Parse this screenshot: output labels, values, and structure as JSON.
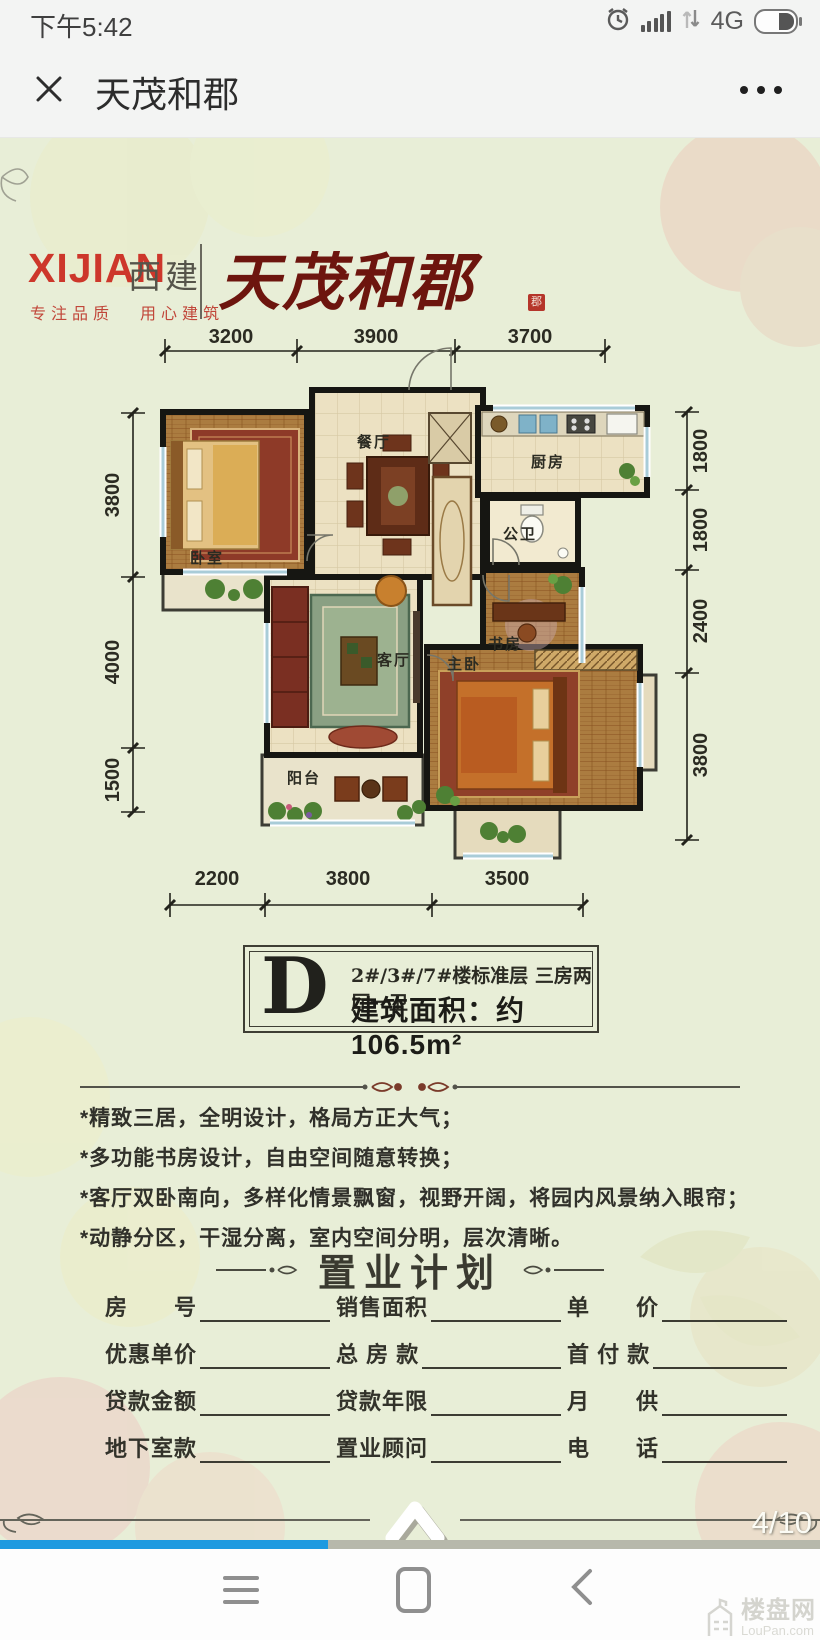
{
  "status_bar": {
    "time": "下午5:42",
    "network": "4G"
  },
  "nav_bar": {
    "title": "天茂和郡"
  },
  "brand": {
    "logo_en": "XIJIAN",
    "logo_cn": "西建",
    "tagline_left": "专注品质",
    "tagline_right": "用心建筑",
    "name": "天茂和郡",
    "seal": "郡"
  },
  "floorplan": {
    "dims_top": [
      "3200",
      "3900",
      "3700"
    ],
    "dims_bottom": [
      "2200",
      "3800",
      "3500"
    ],
    "dims_left": [
      "3800",
      "4000",
      "1500"
    ],
    "dims_right": [
      "1800",
      "1800",
      "2400",
      "3800"
    ],
    "rooms": {
      "bedroom": "卧室",
      "dining": "餐厅",
      "kitchen": "厨房",
      "bath": "公卫",
      "living": "客厅",
      "study": "书房",
      "master": "主卧",
      "balcony": "阳台"
    }
  },
  "unit": {
    "letter": "D",
    "spec": "2#/3#/7#楼标准层 三房两厅一卫",
    "area": "建筑面积：约106.5m²"
  },
  "features": [
    "*精致三居，全明设计，格局方正大气；",
    "*多功能书房设计，自由空间随意转换；",
    "*客厅双卧南向，多样化情景飘窗，视野开阔，将园内风景纳入眼帘；",
    "*动静分区，干湿分离，室内空间分明，层次清晰。"
  ],
  "plan": {
    "title": "置业计划",
    "fields": [
      "房　　号",
      "销售面积",
      "单　　价",
      "优惠单价",
      "总 房 款",
      "首 付 款",
      "贷款金额",
      "贷款年限",
      "月　　供",
      "地下室款",
      "置业顾问",
      "电　　话"
    ]
  },
  "pager": "4/10",
  "progress": {
    "percent": 40
  },
  "watermark": {
    "cn": "楼盘网",
    "en": "LouPan.com"
  },
  "colors": {
    "accent_blue": "#1e9ae0",
    "brand_red": "#cd372b",
    "calligraphy_red": "#6d150e",
    "background_green": "#e8eed7",
    "wall_black": "#161612"
  }
}
